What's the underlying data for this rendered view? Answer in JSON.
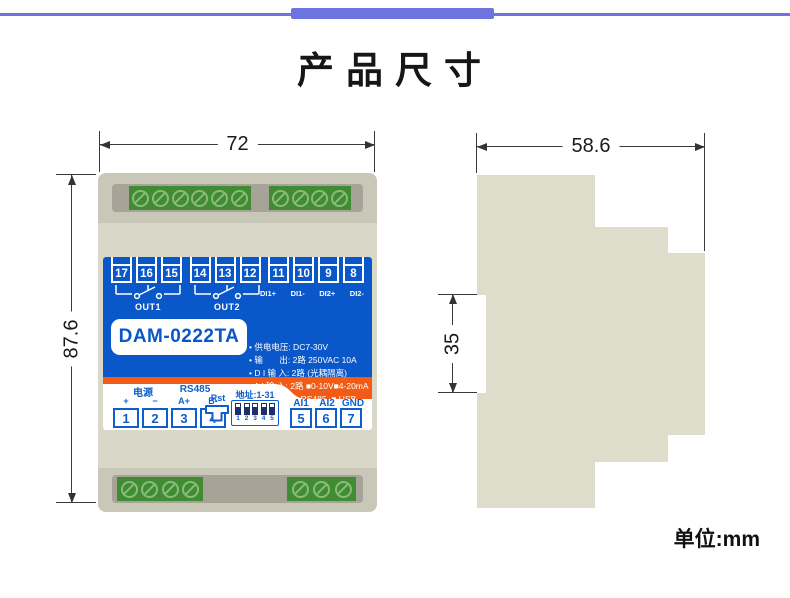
{
  "title": "产品尺寸",
  "unit_label": "单位:mm",
  "colors": {
    "accent_bar": "#6d74e0",
    "panel_blue": "#0957c8",
    "stripe_orange": "#f25b16",
    "terminal_green": "#3f8c33"
  },
  "front_view": {
    "dim_width": "72",
    "dim_height": "87.6",
    "model": "DAM-0222TA",
    "relay1_terminals": [
      "17",
      "16",
      "15"
    ],
    "relay2_terminals": [
      "14",
      "13",
      "12"
    ],
    "out1_label": "OUT1",
    "out2_label": "OUT2",
    "di_terminals": [
      "11",
      "10",
      "9",
      "8"
    ],
    "di_labels": [
      "DI1+",
      "DI1-",
      "DI2+",
      "DI2-"
    ],
    "specs": [
      "• 供电电压: DC7-30V",
      "• 输       出: 2路 250VAC 10A",
      "• D I 输 入: 2路 (光耦隔离)",
      "• A I 输 入: 2路 ■0-10V■4-20mA",
      "• 通讯端口: ■ RS485  ■ USB",
      "                 ■ LORA"
    ],
    "power_label": "电源",
    "rs485_label": "RS485",
    "pin_labels": [
      "+",
      "−",
      "A+",
      "B-"
    ],
    "left_terminals": [
      "1",
      "2",
      "3",
      "4"
    ],
    "rst_label": "Rst",
    "addr_label": "地址:1-31",
    "dip_numbers": [
      "1",
      "2",
      "3",
      "4",
      "5"
    ],
    "ai_labels": [
      "AI1",
      "AI2",
      "GND"
    ],
    "right_terminals": [
      "5",
      "6",
      "7"
    ]
  },
  "side_view": {
    "dim_depth": "58.6",
    "dim_rail": "35"
  }
}
